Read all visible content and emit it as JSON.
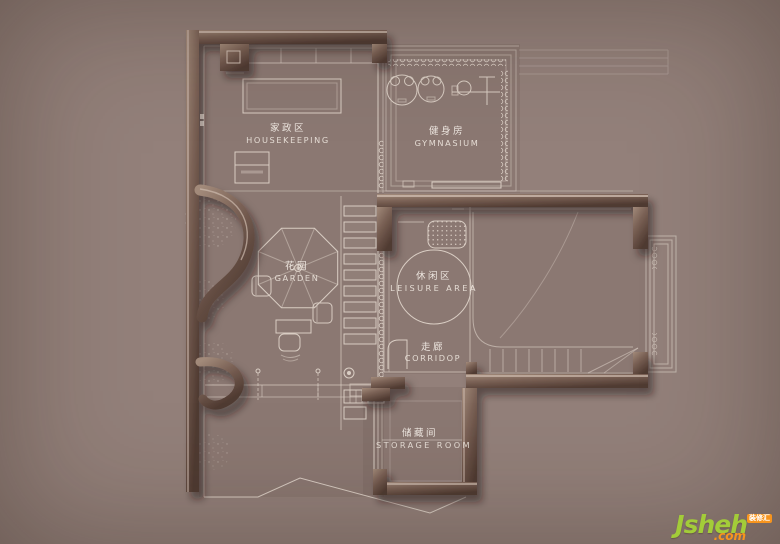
{
  "palette": {
    "background_light": "#bcb1ab",
    "background_dark": "#6b564e",
    "wall_dark": "#4f3a31",
    "wall_light": "#a08878",
    "line": "#e8ddd3",
    "label_text": "#f3ede6",
    "watermark_green": "#a3cc39",
    "watermark_orange": "#f7941d"
  },
  "rooms": [
    {
      "id": "housekeeping",
      "zh": "家政区",
      "en": "HOUSEKEEPING"
    },
    {
      "id": "gymnasium",
      "zh": "健身房",
      "en": "GYMNASIUM"
    },
    {
      "id": "garden",
      "zh": "花园",
      "en": "GARDEN"
    },
    {
      "id": "leisure-area",
      "zh": "休闲区",
      "en": "LEISURE AREA"
    },
    {
      "id": "corridor",
      "zh": "走廊",
      "en": "CORRIDOP"
    },
    {
      "id": "storage-room",
      "zh": "储藏间",
      "en": "STORAGE ROOM"
    }
  ],
  "watermark": {
    "name": "Jsheh",
    "tld": ".com",
    "badge": "装修汇"
  }
}
